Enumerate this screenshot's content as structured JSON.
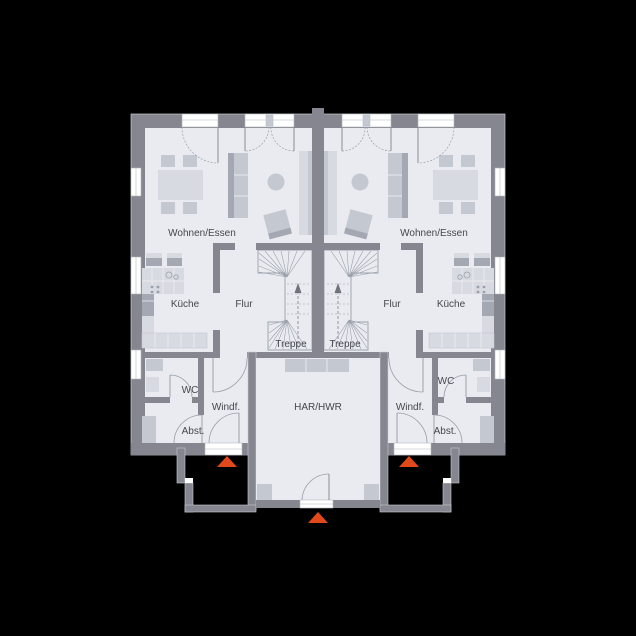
{
  "plan": {
    "type": "ground-floor-plan-semi-detached-house",
    "units": 2,
    "entrances": 3
  },
  "rooms": {
    "living": "Wohnen/Essen",
    "kitchen": "Küche",
    "hall": "Flur",
    "stairs": "Treppe",
    "wc": "WC",
    "vestibule": "Windf.",
    "storage": "Abst.",
    "utility": "HAR/HWR"
  },
  "colors": {
    "background": "#000000",
    "wall": "#85868f",
    "floor": "#e9ebf0",
    "window": "#ffffff",
    "line": "#9aa0aa",
    "leaf": "#8a8e98",
    "furn-light": "#d7dae0",
    "furn-mid": "#c4c8d1",
    "furn-dark": "#a3a8b3",
    "text": "#45474f",
    "accent": "#e2491a",
    "arrow-dark": "#6f737c",
    "outline": "#c9ccd2"
  }
}
